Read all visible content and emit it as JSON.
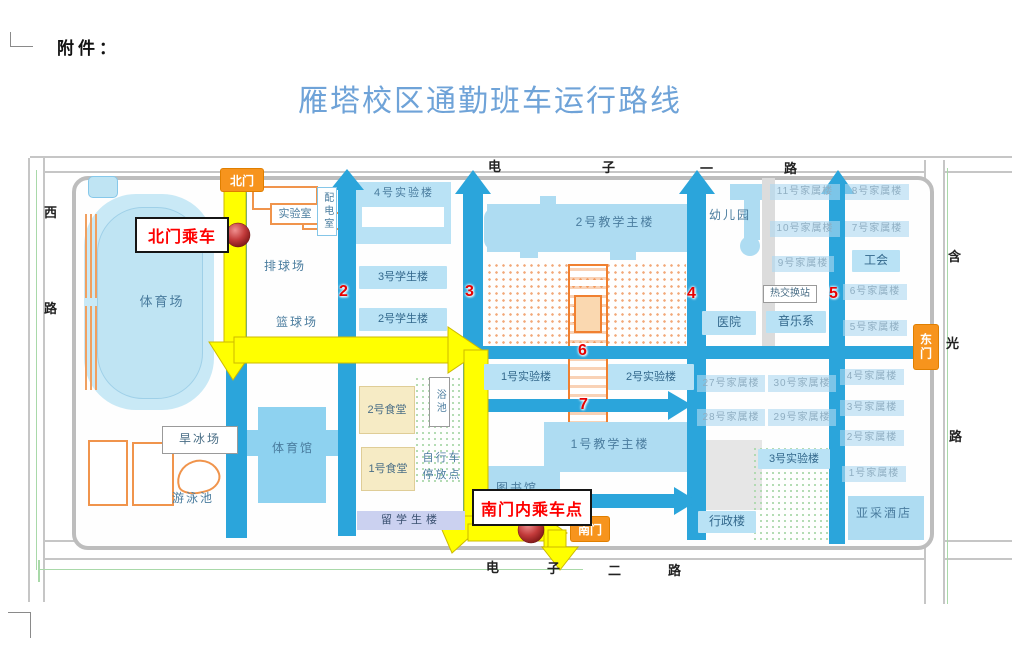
{
  "page": {
    "attachment": "附件：",
    "title": "雁塔校区通勤班车运行路线"
  },
  "roads": {
    "top": [
      "电",
      "子",
      "一",
      "路"
    ],
    "bottom": [
      "电",
      "子",
      "二",
      "路"
    ],
    "left": [
      "西",
      "路"
    ],
    "right": [
      "含",
      "光",
      "路"
    ]
  },
  "gates": {
    "north": "北门",
    "south": "南门",
    "east": "东门"
  },
  "stops": {
    "north": "北门乘车",
    "south": "南门内乘车点"
  },
  "route_numbers": [
    "2",
    "3",
    "4",
    "5",
    "6",
    "7"
  ],
  "buildings": [
    {
      "label": "体育场",
      "x": 128,
      "y": 293,
      "w": 68,
      "h": 18,
      "cls": "txt",
      "fs": 13
    },
    {
      "label": "排球场",
      "x": 252,
      "y": 259,
      "w": 66,
      "h": 16,
      "cls": "txt"
    },
    {
      "label": "篮球场",
      "x": 264,
      "y": 315,
      "w": 66,
      "h": 16,
      "cls": "txt"
    },
    {
      "label": "实验室",
      "x": 270,
      "y": 203,
      "w": 46,
      "h": 18,
      "cls": "obox"
    },
    {
      "label": "配电室",
      "x": 317,
      "y": 187,
      "w": 18,
      "h": 47,
      "cls": "vbox"
    },
    {
      "label": "4号实验楼",
      "x": 357,
      "y": 184,
      "w": 94,
      "h": 18,
      "cls": "txt",
      "fs": 11
    },
    {
      "label": "3号学生楼",
      "x": 359,
      "y": 266,
      "w": 88,
      "h": 23,
      "cls": "b"
    },
    {
      "label": "2号学生楼",
      "x": 359,
      "y": 308,
      "w": 88,
      "h": 23,
      "cls": "b"
    },
    {
      "label": "2号教学主楼",
      "x": 570,
      "y": 214,
      "w": 90,
      "h": 17,
      "cls": "txt",
      "fs": 12
    },
    {
      "label": "幼儿园",
      "x": 704,
      "y": 207,
      "w": 52,
      "h": 17,
      "cls": "txt"
    },
    {
      "label": "11号家属楼",
      "x": 770,
      "y": 184,
      "w": 70,
      "h": 16,
      "cls": "fam"
    },
    {
      "label": "8号家属楼",
      "x": 845,
      "y": 184,
      "w": 64,
      "h": 16,
      "cls": "fam"
    },
    {
      "label": "10号家属楼",
      "x": 770,
      "y": 221,
      "w": 70,
      "h": 16,
      "cls": "fam"
    },
    {
      "label": "7号家属楼",
      "x": 845,
      "y": 221,
      "w": 64,
      "h": 16,
      "cls": "fam"
    },
    {
      "label": "9号家属楼",
      "x": 772,
      "y": 256,
      "w": 62,
      "h": 16,
      "cls": "fam"
    },
    {
      "label": "工会",
      "x": 852,
      "y": 250,
      "w": 48,
      "h": 22,
      "cls": "b",
      "fs": 12
    },
    {
      "label": "热交换站",
      "x": 763,
      "y": 285,
      "w": 52,
      "h": 16,
      "cls": "white"
    },
    {
      "label": "6号家属楼",
      "x": 843,
      "y": 284,
      "w": 64,
      "h": 16,
      "cls": "fam"
    },
    {
      "label": "医院",
      "x": 702,
      "y": 311,
      "w": 54,
      "h": 24,
      "cls": "b",
      "fs": 12
    },
    {
      "label": "音乐系",
      "x": 766,
      "y": 311,
      "w": 60,
      "h": 22,
      "cls": "b",
      "fs": 12
    },
    {
      "label": "5号家属楼",
      "x": 843,
      "y": 320,
      "w": 64,
      "h": 16,
      "cls": "fam"
    },
    {
      "label": "2号食堂",
      "x": 359,
      "y": 386,
      "w": 54,
      "h": 46,
      "cls": "food"
    },
    {
      "label": "浴池",
      "x": 429,
      "y": 377,
      "w": 19,
      "h": 48,
      "cls": "vbox2"
    },
    {
      "label": "1号实验楼",
      "x": 484,
      "y": 364,
      "w": 84,
      "h": 26,
      "cls": "b"
    },
    {
      "label": "2号实验楼",
      "x": 608,
      "y": 364,
      "w": 86,
      "h": 26,
      "cls": "b"
    },
    {
      "label": "27号家属楼",
      "x": 697,
      "y": 375,
      "w": 68,
      "h": 17,
      "cls": "fam"
    },
    {
      "label": "30号家属楼",
      "x": 768,
      "y": 375,
      "w": 68,
      "h": 17,
      "cls": "fam"
    },
    {
      "label": "4号家属楼",
      "x": 840,
      "y": 369,
      "w": 64,
      "h": 16,
      "cls": "fam"
    },
    {
      "label": "28号家属楼",
      "x": 697,
      "y": 409,
      "w": 68,
      "h": 17,
      "cls": "fam"
    },
    {
      "label": "29号家属楼",
      "x": 768,
      "y": 409,
      "w": 68,
      "h": 17,
      "cls": "fam"
    },
    {
      "label": "3号家属楼",
      "x": 840,
      "y": 400,
      "w": 64,
      "h": 16,
      "cls": "fam"
    },
    {
      "label": "1号食堂",
      "x": 361,
      "y": 447,
      "w": 52,
      "h": 42,
      "cls": "food"
    },
    {
      "label": "自行车停放点",
      "x": 417,
      "y": 449,
      "w": 50,
      "h": 38,
      "cls": "txt2"
    },
    {
      "label": "1号教学主楼",
      "x": 566,
      "y": 436,
      "w": 88,
      "h": 17,
      "cls": "txt",
      "fs": 12
    },
    {
      "label": "2号家属楼",
      "x": 840,
      "y": 430,
      "w": 64,
      "h": 16,
      "cls": "fam"
    },
    {
      "label": "3号实验楼",
      "x": 758,
      "y": 449,
      "w": 72,
      "h": 20,
      "cls": "b"
    },
    {
      "label": "1号家属楼",
      "x": 842,
      "y": 466,
      "w": 64,
      "h": 16,
      "cls": "fam"
    },
    {
      "label": "图书馆",
      "x": 488,
      "y": 480,
      "w": 58,
      "h": 17,
      "cls": "txt"
    },
    {
      "label": "留学生楼",
      "x": 357,
      "y": 511,
      "w": 108,
      "h": 19,
      "cls": "intl"
    },
    {
      "label": "行政楼",
      "x": 698,
      "y": 511,
      "w": 58,
      "h": 22,
      "cls": "b",
      "fs": 12
    },
    {
      "label": "亚采酒店",
      "x": 852,
      "y": 505,
      "w": 64,
      "h": 18,
      "cls": "txt",
      "fs": 12
    },
    {
      "label": "旱冰场",
      "x": 162,
      "y": 426,
      "w": 74,
      "h": 26,
      "cls": "white2"
    },
    {
      "label": "游泳池",
      "x": 164,
      "y": 491,
      "w": 58,
      "h": 16,
      "cls": "txt"
    },
    {
      "label": "体育馆",
      "x": 263,
      "y": 440,
      "w": 60,
      "h": 18,
      "cls": "txt"
    }
  ],
  "colors": {
    "road_blue": "#2BA5DB",
    "route_yellow": "#FFFF00",
    "gate_orange": "#F7941D",
    "stop_red": "#FE0000",
    "building_blue": "#B9E2F5",
    "title_blue": "#6FA3D8",
    "marker_red": "#A22525",
    "garden_orange": "#F08030"
  }
}
